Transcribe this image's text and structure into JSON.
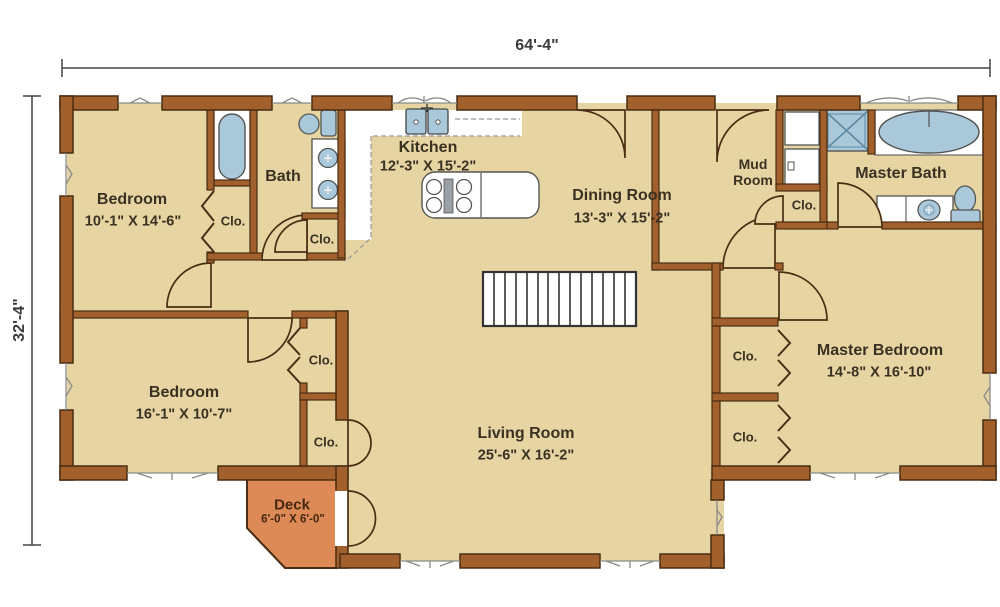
{
  "dimensions": {
    "width": "64'-4\"",
    "height": "32'-4\""
  },
  "rooms": {
    "bedroom1": {
      "name": "Bedroom",
      "size": "10'-1\" X 14'-6\""
    },
    "bath": {
      "name": "Bath"
    },
    "kitchen": {
      "name": "Kitchen",
      "size": "12'-3\" X 15'-2\""
    },
    "dining_room": {
      "name": "Dining Room",
      "size": "13'-3\" X 15'-2\""
    },
    "mud_room": {
      "name": "Mud Room"
    },
    "master_bath": {
      "name": "Master Bath"
    },
    "bedroom2": {
      "name": "Bedroom",
      "size": "16'-1\" X 10'-7\""
    },
    "living_room": {
      "name": "Living Room",
      "size": "25'-6\" X 16'-2\""
    },
    "master_bedroom": {
      "name": "Master Bedroom",
      "size": "14'-8\" X 16'-10\""
    },
    "deck": {
      "name": "Deck",
      "size": "6'-0\" X 6'-0\""
    }
  },
  "closet_labels": [
    "Clo.",
    "Clo.",
    "Clo.",
    "Clo.",
    "Clo.",
    "Clo.",
    "Clo."
  ],
  "colors": {
    "background": "#FFFFFF",
    "floor": "#E6D5A3",
    "wall": "#A2602C",
    "wall_outline": "#4A2D12",
    "deck": "#DE8A57",
    "fixture_blue": "#A9C8DA",
    "fixture_outline": "#555555",
    "text": "#3B3122",
    "dimension_line": "#444444"
  },
  "fixtures": [
    "bathtub-icon",
    "toilet-icon",
    "vanity-double-sink-icon",
    "kitchen-sink-icon",
    "cooktop-island-icon",
    "kitchen-counter-icon",
    "stairs-icon",
    "washer-icon",
    "dryer-icon",
    "shower-icon",
    "garden-tub-icon",
    "vanity-sink-icon",
    "toilet-icon"
  ]
}
